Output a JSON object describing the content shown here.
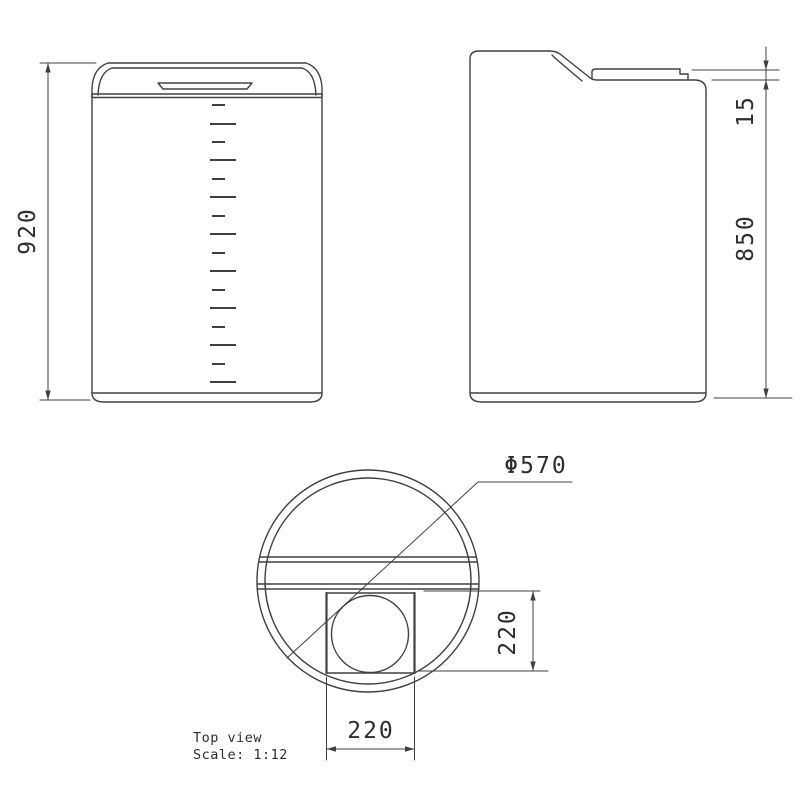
{
  "dimensions": {
    "front_height": "920",
    "side_lid_offset": "15",
    "side_body_height": "850",
    "top_diameter": "Φ570",
    "opening_width": "220",
    "opening_depth": "220"
  },
  "caption": {
    "view_label": "Top view",
    "scale_label": "Scale:  1:12"
  },
  "colors": {
    "line": "#404040",
    "text": "#2e2e2e",
    "background": "#ffffff"
  }
}
